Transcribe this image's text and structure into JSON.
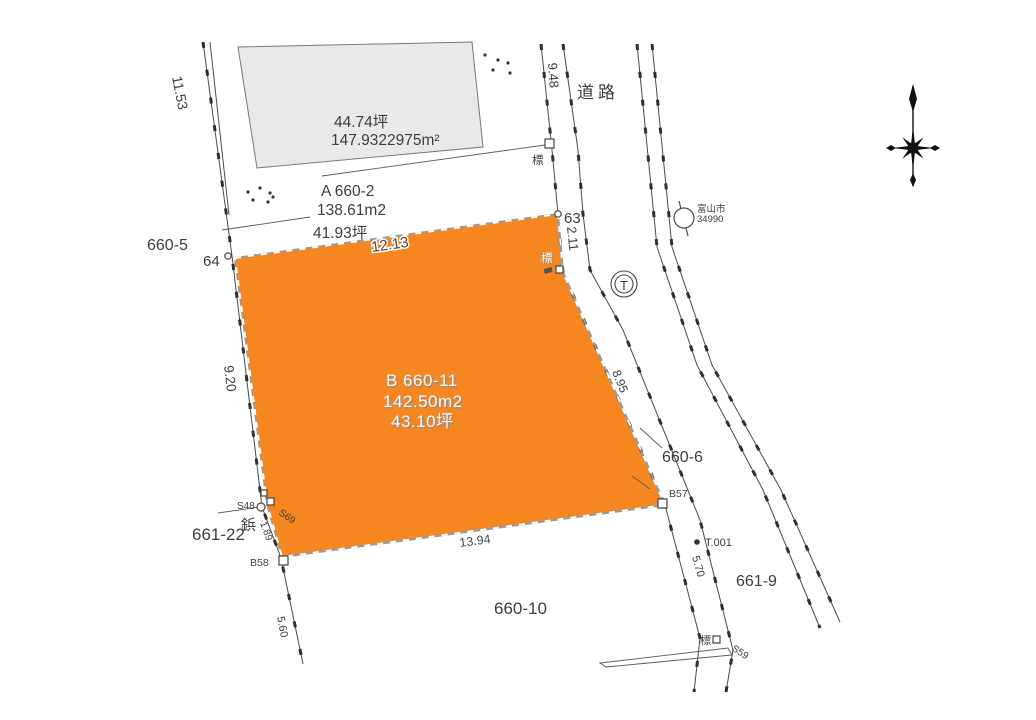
{
  "labels": {
    "road": "道路",
    "parcel_660_5": "660-5",
    "parcel_660_6": "660-6",
    "parcel_660_10": "660-10",
    "parcel_661_9": "661-9",
    "parcel_661_22": "661-22",
    "parcel_a_id": "A 660-2",
    "parcel_a_area_m2": "138.61m2",
    "parcel_a_area_tsubo": "41.93坪",
    "parcel_b_id": "B 660-11",
    "parcel_b_area_m2": "142.50m2",
    "parcel_b_area_tsubo": "43.10坪",
    "building_area_tsubo": "44.74坪",
    "building_area_m2": "147.9322975m²",
    "point_63": "63",
    "point_64": "64",
    "marker_s48": "S48",
    "marker_s69": "S69",
    "marker_s59": "S59",
    "marker_b57": "B57",
    "marker_b58": "B58",
    "marker_t001": "T.001",
    "survey_marker": "標",
    "nail": "鋲",
    "city_name": "富山市",
    "city_number": "34990",
    "pole_letter": "T"
  },
  "dimensions": {
    "left_upper": "11.53",
    "road_width_top": "9.48",
    "edge_63": "2.11",
    "parcel_b_north": "12.13",
    "parcel_b_west": "9.20",
    "parcel_b_east": "8.95",
    "parcel_b_south": "13.94",
    "edge_s48_b58": "1.89",
    "below_b58": "5.60",
    "edge_b57_south": "5.70"
  },
  "colors": {
    "highlight_parcel": "#F6861F",
    "building_fill": "#E9E9E9",
    "line": "#4a4a4a"
  }
}
